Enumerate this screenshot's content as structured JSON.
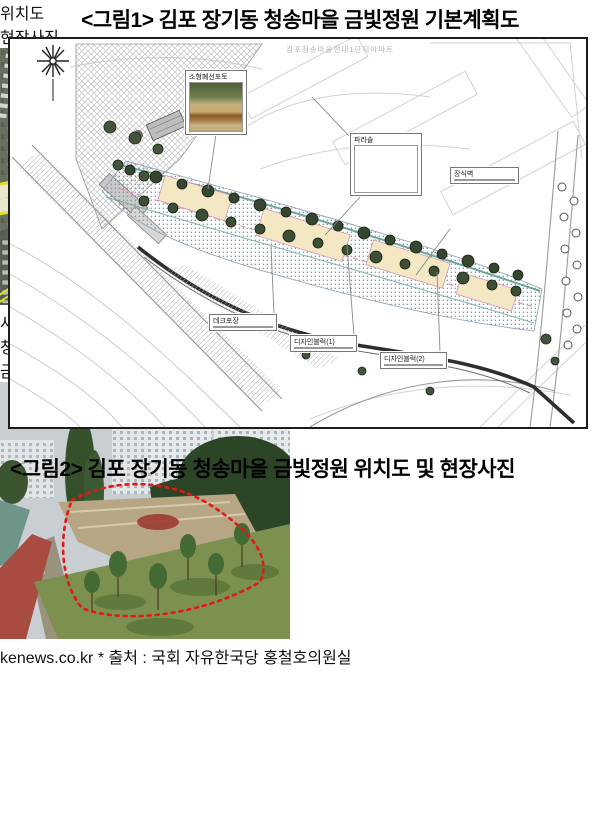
{
  "figure1": {
    "title": "<그림1> 김포 장기동 청송마을 금빛정원 기본계획도",
    "plan": {
      "bg_text": "김포청송마을현대1단지아파트",
      "insets": [
        {
          "label": "소형폐선포토"
        },
        {
          "label": "파라솔"
        },
        {
          "label": "장식벽"
        },
        {
          "label": "데크포장"
        },
        {
          "label": "디자인블럭(1)"
        },
        {
          "label": "디자인블럭(2)"
        }
      ]
    }
  },
  "figure2": {
    "title": "<그림2> 김포 장기동 청송마을 금빛정원 위치도 및 현장사진",
    "columns": [
      {
        "header": "위치도"
      },
      {
        "header": "현장사진"
      }
    ],
    "map_labels": [
      {
        "text": "사업대상지"
      },
      {
        "text": "청송 현대1단지"
      },
      {
        "text": "금빛수로"
      }
    ]
  },
  "footer": {
    "source": "* 출처 : 국회 자유한국당 홍철호의원실",
    "watermark": "kenews.co.kr"
  },
  "colors": {
    "site_outline_red": "#dd1c1c",
    "road_yellow": "#e2e22a",
    "garden_teal": "#6aa898",
    "garden_pink": "#e090c0",
    "header_gray": "#e9e9e9"
  }
}
